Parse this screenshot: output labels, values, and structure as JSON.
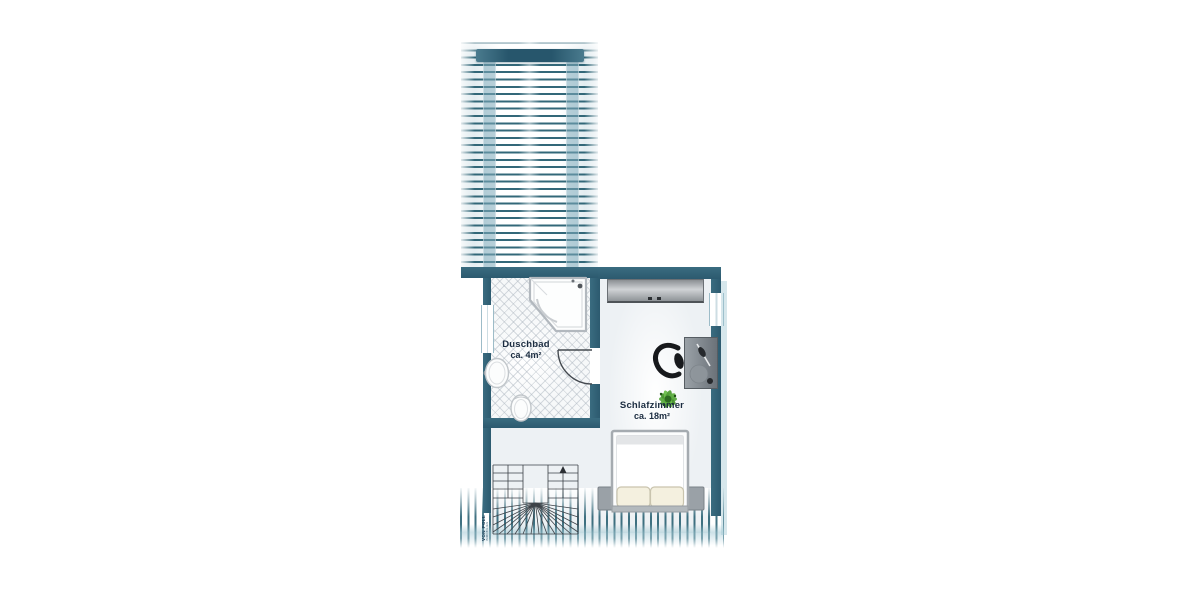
{
  "floorplan": {
    "rooms": {
      "bathroom": {
        "name": "Duschbad",
        "area": "ca. 4m²"
      },
      "bedroom": {
        "name": "Schlafzimmer",
        "area": "ca. 18m²"
      }
    },
    "watermark": {
      "brand": "VON POLL",
      "sub": "IMMOBILIEN"
    },
    "colors": {
      "wall_teal": "#31637a",
      "glass_teal": "#8fb9c9",
      "stripe_teal": "#2f6679",
      "light_band": "#aecdd8",
      "floor_light": "#edf1f4",
      "tile_line": "#aab2bc",
      "furniture_gray": "#8e959b",
      "bed_white": "#fdfdfc",
      "pillow_cream": "#f4f0df",
      "plant_green": "#58a63d",
      "chair_black": "#17191c",
      "label_navy": "#1b2c40",
      "stair_line": "#3d4248"
    },
    "elements": [
      "roof-terrace-slats",
      "glass-canopy-frame",
      "corner-bathtub",
      "washbasin",
      "toilet",
      "door-swing",
      "half-turn-staircase",
      "up-arrow",
      "window-left",
      "window-right",
      "wardrobe",
      "double-bed",
      "nightstands",
      "desk",
      "office-chair",
      "potted-plant",
      "knee-wall-hatching"
    ]
  }
}
